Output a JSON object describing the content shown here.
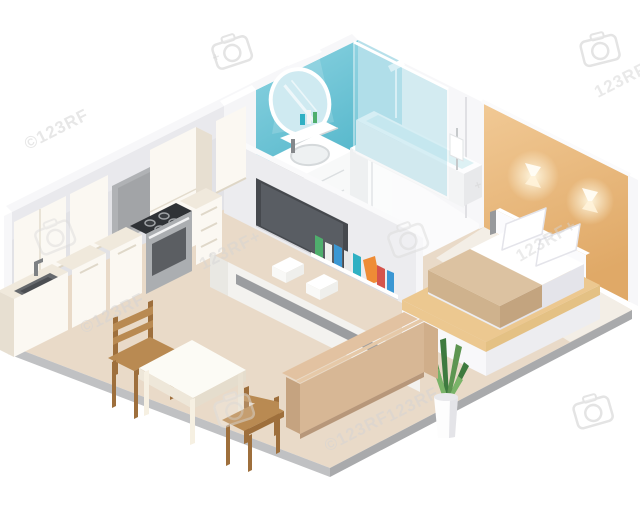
{
  "watermark": {
    "copyright": "©123RF",
    "brand": "123RF",
    "brand_plus": "123RF+",
    "plus": "+"
  },
  "colors": {
    "watermark": "#d4d4d4",
    "teal_wall": "#69c4d6",
    "teal_wall_light": "#8ed4e2",
    "teal_wall_deep": "#55b7cb",
    "glass": "#a9dde9",
    "wall_gray": "#e2e2e6",
    "wall_gray_light": "#ededf0",
    "wall_white": "#f7f7f9",
    "divider_white": "#f5f5f7",
    "tan_wall": "#eaba81",
    "tan_wall_light": "#f1c995",
    "tan_wall_deep": "#e0a967",
    "floor": "#e9dac8",
    "floor_bedroom": "#f3eee6",
    "floor_bath": "#fbfbfc",
    "skirt_left": "#c0c1c3",
    "skirt_right": "#a9aaac",
    "cream_top": "#f0e9dc",
    "cream_front": "#fbf8f2",
    "cream_side": "#e7dfd1",
    "gray_unit": "#b0b2b5",
    "stove_black": "#2f3236",
    "steel": "#abaeb1",
    "oven_window": "#5b5e62",
    "wood": "#b98a52",
    "wood_dark": "#9e6f3c",
    "table_white": "#fcfbf5",
    "sofa": "#d7b795",
    "sofa_light": "#e6c9a8",
    "sofa_side": "#c5a380",
    "sofa_dark": "#b7977a",
    "mattress": "#ffffff",
    "mattress_shade": "#ededf1",
    "blanket": "#dcc2a1",
    "blanket_dark": "#cfb28d",
    "platform_wood": "#ecc890",
    "headboard_side": "#97999c",
    "plant_green": "#5d9551",
    "plant_dark": "#3e7a3f",
    "pot_white": "#fdfdfd",
    "tv_bezel": "#46494e",
    "tv_screen": "#595d63",
    "console_gray": "#9b9da0",
    "book_1": "#4fae6d",
    "book_2": "#f0f0ee",
    "book_3": "#3b97d3",
    "book_4": "#e8e8e8",
    "book_5": "#2fb0c3",
    "book_6": "#ee8c36",
    "book_7": "#d5544c"
  }
}
